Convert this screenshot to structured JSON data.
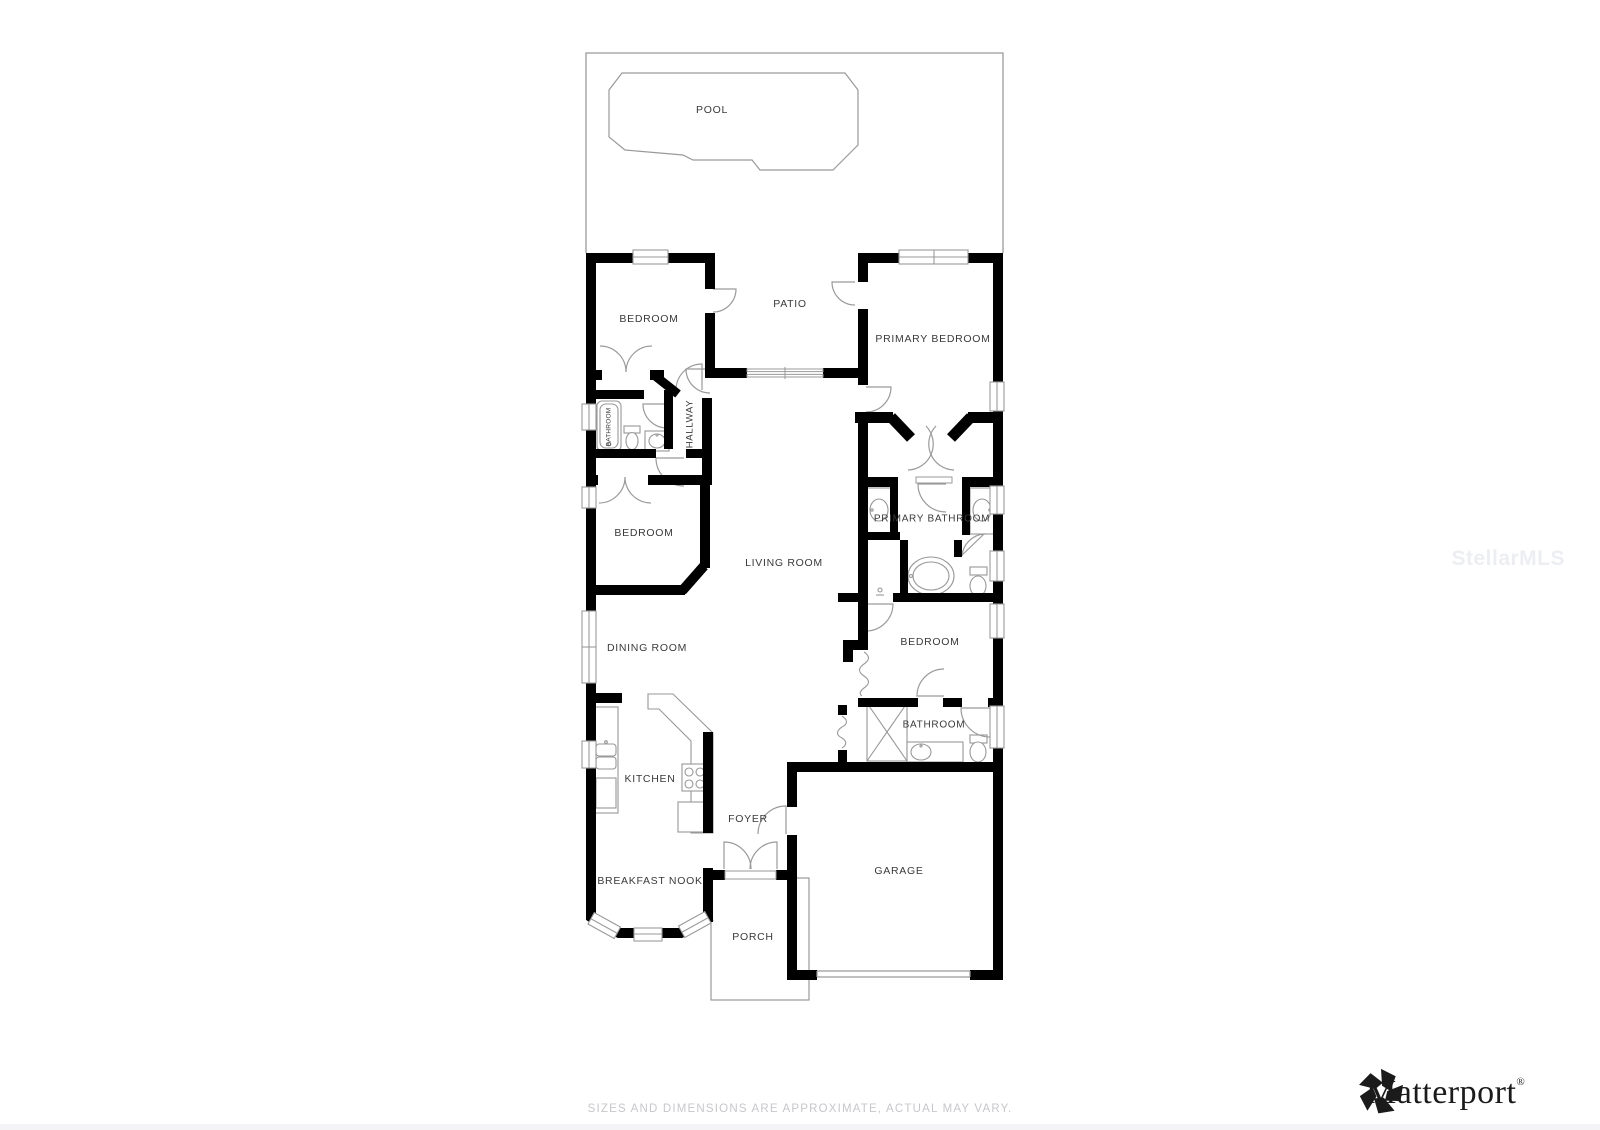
{
  "rooms": {
    "pool": {
      "label": "POOL"
    },
    "patio": {
      "label": "PATIO"
    },
    "bedroom_top": {
      "label": "BEDROOM"
    },
    "primary_bedroom": {
      "label": "PRIMARY BEDROOM"
    },
    "bathroom_hall": {
      "label": "BATHROOM"
    },
    "hallway": {
      "label": "HALLWAY"
    },
    "bedroom_middle": {
      "label": "BEDROOM"
    },
    "living_room": {
      "label": "LIVING ROOM"
    },
    "primary_bathroom": {
      "label": "PRIMARY BATHROOM"
    },
    "dining_room": {
      "label": "DINING ROOM"
    },
    "bedroom_right": {
      "label": "BEDROOM"
    },
    "kitchen": {
      "label": "KITCHEN"
    },
    "bathroom_right": {
      "label": "BATHROOM"
    },
    "foyer": {
      "label": "FOYER"
    },
    "breakfast_nook": {
      "label": "BREAKFAST NOOK"
    },
    "garage": {
      "label": "GARAGE"
    },
    "porch": {
      "label": "PORCH"
    }
  },
  "footer": {
    "disclaimer": "SIZES AND DIMENSIONS ARE APPROXIMATE, ACTUAL MAY VARY."
  },
  "watermark": {
    "text": "StellarMLS"
  },
  "branding": {
    "logo_text": "Matterport",
    "registered_mark": "®",
    "icon": "matterport-pinwheel-icon"
  },
  "colors": {
    "wall": "#000000",
    "thin_line": "#979797",
    "label_text": "#3a3a3a",
    "footer_text": "#c7c7cb",
    "watermark_text": "#eceef2",
    "logo_text": "#1b1b1b",
    "background": "#ffffff"
  }
}
